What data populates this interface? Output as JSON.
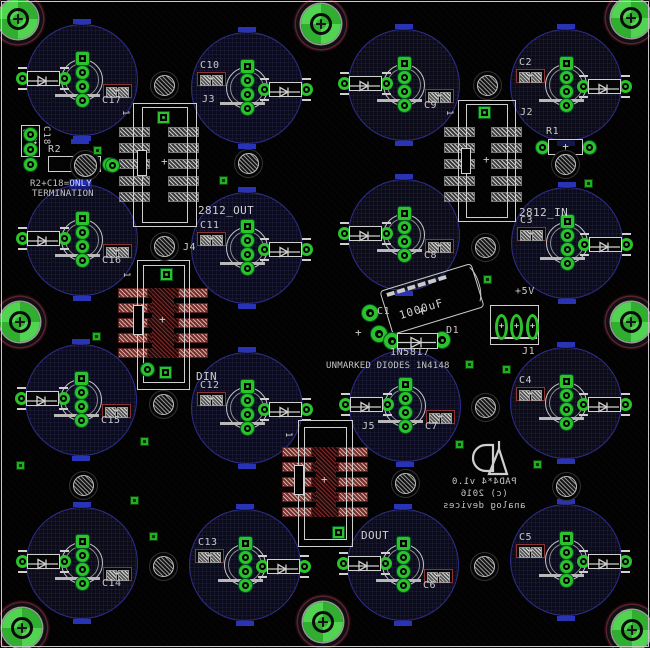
{
  "colors": {
    "pad_green": "#2bc22b",
    "silk": "#d2d2d2",
    "copper_red": "#9c4040",
    "circle_outline": "#2d2d8c",
    "blue_mark": "#2833b5",
    "board_bg": "#020202"
  },
  "title_block": {
    "line1": "PAD4*4 v1.0",
    "line2": "(c) 2016",
    "line3": "analog devices"
  },
  "silkscreen": {
    "termination_prefix": "R2+C18=",
    "termination_hl": "ONLY",
    "termination_line2": "TERMINATION",
    "unmarked_note": "UNMARKED DIODES 1N4148",
    "out_label": "2812_OUT",
    "in_label": "2812_IN",
    "din_label": "DIN",
    "dout_label": "DOUT",
    "power_label": "+5V",
    "pin1": "1",
    "c1_ref": "C1",
    "c1_value": "1000uF",
    "d1_ref": "D1",
    "d1_part": "1N5817",
    "r1_ref": "R1",
    "r2_ref": "R2",
    "c18_ref": "C18",
    "j1_ref": "J1"
  },
  "cap_groups": [
    {
      "ref": "C17",
      "cx": 82,
      "cy": 80,
      "variant": "A"
    },
    {
      "ref": "C10",
      "cx": 247,
      "cy": 88,
      "variant": "B"
    },
    {
      "ref": "C9",
      "cx": 404,
      "cy": 85,
      "variant": "A"
    },
    {
      "ref": "C2",
      "cx": 566,
      "cy": 85,
      "variant": "B"
    },
    {
      "ref": "C16",
      "cx": 82,
      "cy": 240,
      "variant": "A"
    },
    {
      "ref": "C11",
      "cx": 247,
      "cy": 248,
      "variant": "B"
    },
    {
      "ref": "C8",
      "cx": 404,
      "cy": 235,
      "variant": "A"
    },
    {
      "ref": "C3",
      "cx": 567,
      "cy": 243,
      "variant": "B"
    },
    {
      "ref": "C15",
      "cx": 81,
      "cy": 400,
      "variant": "A"
    },
    {
      "ref": "C12",
      "cx": 247,
      "cy": 408,
      "variant": "B"
    },
    {
      "ref": "C7",
      "cx": 405,
      "cy": 406,
      "variant": "A"
    },
    {
      "ref": "C4",
      "cx": 566,
      "cy": 403,
      "variant": "B"
    },
    {
      "ref": "C14",
      "cx": 82,
      "cy": 563,
      "variant": "A"
    },
    {
      "ref": "C13",
      "cx": 245,
      "cy": 565,
      "variant": "B"
    },
    {
      "ref": "C6",
      "cx": 403,
      "cy": 565,
      "variant": "A"
    },
    {
      "ref": "C5",
      "cx": 566,
      "cy": 560,
      "variant": "B"
    }
  ],
  "headers": [
    {
      "ref": "J3",
      "style": "gray",
      "outline": [
        133,
        103,
        64,
        124
      ],
      "inner": [
        142,
        107,
        46,
        116
      ],
      "notch": [
        137,
        150,
        10,
        26
      ],
      "pads_x": [
        119,
        168
      ],
      "pad_w": 31,
      "rows_y": [
        127,
        143,
        159,
        176,
        192
      ],
      "cross": [
        165,
        163
      ],
      "label_xy": [
        202,
        94
      ],
      "pin1_xy": [
        120,
        110
      ],
      "greens": [
        [
          "sq",
          163,
          117
        ],
        [
          "ring",
          112,
          165
        ]
      ]
    },
    {
      "ref": "J2",
      "style": "gray",
      "outline": [
        458,
        100,
        58,
        122
      ],
      "inner": [
        466,
        104,
        42,
        114
      ],
      "notch": [
        461,
        148,
        10,
        26
      ],
      "pads_x": [
        444,
        491
      ],
      "pad_w": 31,
      "rows_y": [
        127,
        143,
        159,
        176,
        192
      ],
      "cross": [
        487,
        161
      ],
      "label_xy": [
        520,
        107
      ],
      "pin1_xy": [
        444,
        110
      ],
      "greens": [
        [
          "sq",
          484,
          112
        ]
      ]
    },
    {
      "ref": "J4",
      "style": "red",
      "outline": [
        137,
        260,
        53,
        130
      ],
      "inner": [
        143,
        265,
        42,
        118
      ],
      "notch": [
        133,
        305,
        10,
        30
      ],
      "band": [
        118,
        90
      ],
      "mid": [
        152,
        288,
        22,
        70
      ],
      "pads_x": [
        118,
        178
      ],
      "pad_w": 30,
      "rows_y": [
        288,
        303,
        318,
        333,
        348
      ],
      "cross": [
        163,
        321
      ],
      "label_xy": [
        183,
        242
      ],
      "pin1_xy": [
        121,
        272
      ],
      "greens": [
        [
          "sq",
          166,
          274
        ],
        [
          "ring",
          147,
          369
        ],
        [
          "sq",
          165,
          372
        ]
      ]
    },
    {
      "ref": "J5",
      "style": "red",
      "outline": [
        298,
        420,
        55,
        127
      ],
      "inner": [
        304,
        427,
        43,
        113
      ],
      "notch": [
        294,
        465,
        10,
        30
      ],
      "band": [
        282,
        86
      ],
      "mid": [
        316,
        448,
        20,
        69
      ],
      "pads_x": [
        282,
        338
      ],
      "pad_w": 30,
      "rows_y": [
        447,
        462,
        477,
        492,
        507
      ],
      "cross": [
        325,
        481
      ],
      "label_xy": [
        362,
        421
      ],
      "pin1_xy": [
        283,
        432
      ],
      "greens": [
        [
          "sq",
          338,
          532
        ]
      ]
    }
  ],
  "mount_holes": [
    [
      18,
      19
    ],
    [
      321,
      24
    ],
    [
      631,
      18
    ],
    [
      20,
      322
    ],
    [
      631,
      322
    ],
    [
      22,
      628
    ],
    [
      323,
      622
    ],
    [
      632,
      630
    ]
  ],
  "hatch_circles": [
    [
      164,
      85
    ],
    [
      487,
      85
    ],
    [
      248,
      163
    ],
    [
      565,
      164
    ],
    [
      164,
      246
    ],
    [
      485,
      247
    ],
    [
      163,
      404
    ],
    [
      485,
      407
    ],
    [
      83,
      485
    ],
    [
      405,
      483
    ],
    [
      566,
      486
    ],
    [
      163,
      566
    ],
    [
      484,
      566
    ]
  ],
  "vias": [
    [
      97,
      150
    ],
    [
      223,
      180
    ],
    [
      588,
      183
    ],
    [
      96,
      336
    ],
    [
      144,
      441
    ],
    [
      20,
      465
    ],
    [
      134,
      500
    ],
    [
      153,
      536
    ],
    [
      487,
      279
    ],
    [
      469,
      364
    ],
    [
      506,
      369
    ],
    [
      459,
      444
    ],
    [
      537,
      464
    ]
  ],
  "extra_marks": {
    "blue_dash": [
      71,
      139
    ]
  }
}
